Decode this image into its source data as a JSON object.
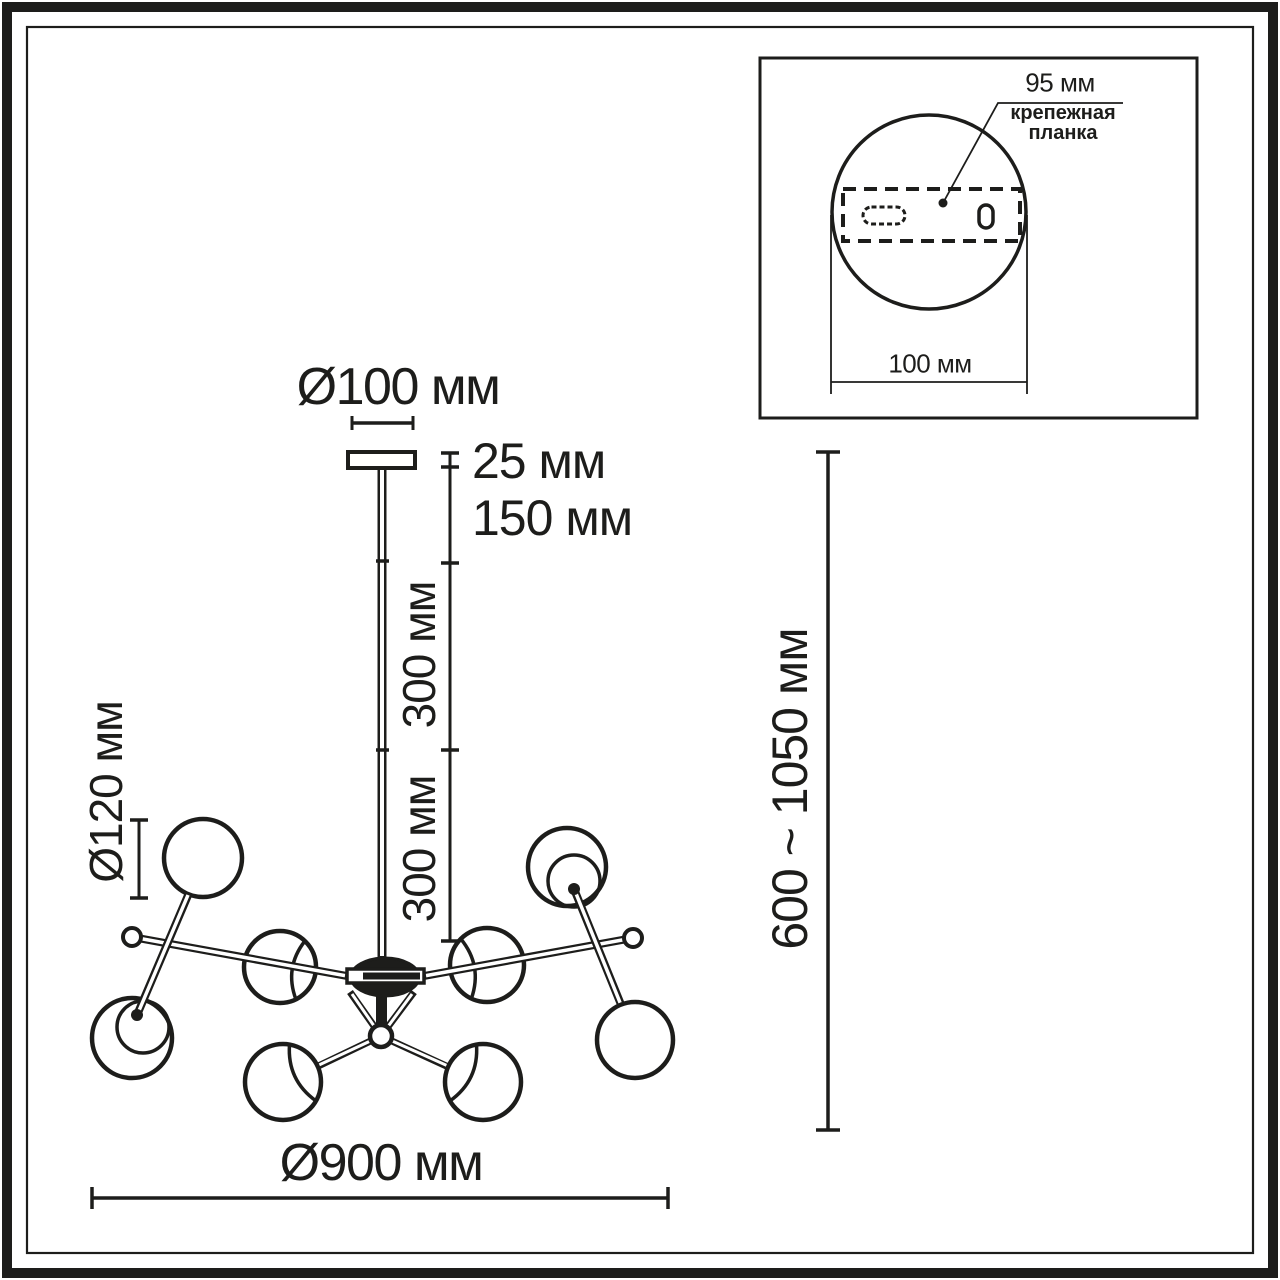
{
  "colors": {
    "ink": "#1d1d1b",
    "paper": "#ffffff"
  },
  "main_view": {
    "canopy_diameter": "Ø100 мм",
    "canopy_thickness": "25 мм",
    "rod_section_upper": "150 мм",
    "rod_section_middle": "300 мм",
    "rod_section_lower": "300 мм",
    "ball_diameter": "Ø120 мм",
    "fixture_diameter": "Ø900 мм",
    "suspension_height_range": "600 ~ 1050 мм"
  },
  "mount_inset": {
    "plate_width": "95 мм",
    "plate_caption_line1": "крепежная",
    "plate_caption_line2": "планка",
    "canopy_base_diameter": "100 мм"
  }
}
